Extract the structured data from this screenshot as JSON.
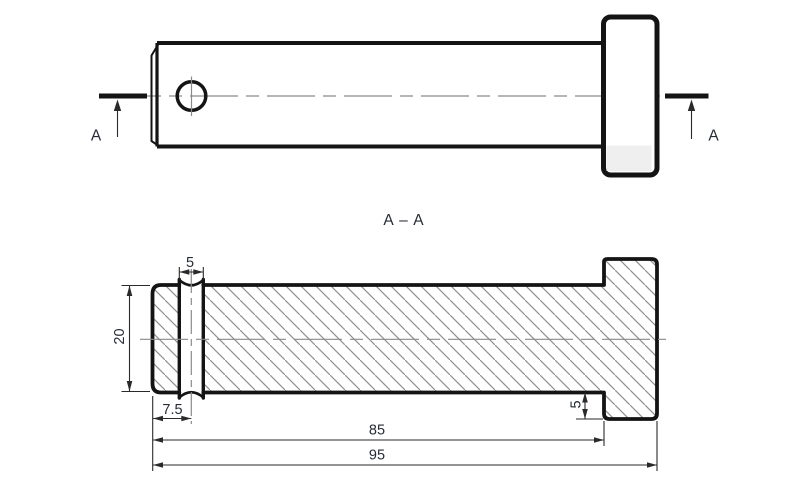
{
  "front_view": {
    "cut_label_left": "A",
    "cut_label_right": "A"
  },
  "section_view": {
    "title": "A – A",
    "dimensions": {
      "hole_width": "5",
      "diameter": "20",
      "hole_center_offset": "7.5",
      "head_step": "5",
      "length_to_head": "85",
      "overall_length": "95"
    }
  },
  "colors": {
    "outline": "#141414",
    "hatch_line": "#8f8f8f",
    "centerline": "#8a8a8a",
    "dimension_line": "#2a2a2a",
    "text": "#262b36",
    "head_recess_fill": "#efefef",
    "background": "#ffffff"
  }
}
